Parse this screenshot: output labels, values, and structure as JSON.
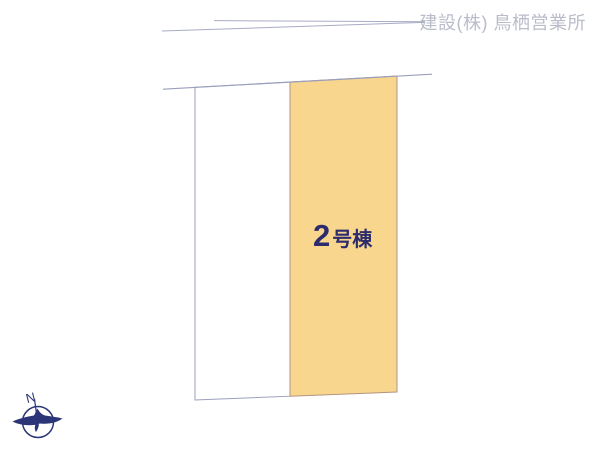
{
  "header": {
    "company_watermark": "建設(株) 鳥栖営業所"
  },
  "plan": {
    "building_label": {
      "number": "2",
      "suffix": "号棟"
    },
    "parcels": [
      {
        "name": "vacant-parcel",
        "fill": "#ffffff",
        "label": ""
      },
      {
        "name": "building-2-parcel",
        "fill": "#f8d68e",
        "label": "2号棟"
      }
    ],
    "colors": {
      "boundary_line": "#9b9fbc",
      "road_line": "#a8abc4",
      "highlight_fill": "#f8d68e",
      "highlight_border": "#b2947e",
      "label_text": "#2c2c6c",
      "watermark_text": "#b9bcc9",
      "compass": "#2b3578"
    }
  },
  "compass": {
    "north_label": "N"
  }
}
